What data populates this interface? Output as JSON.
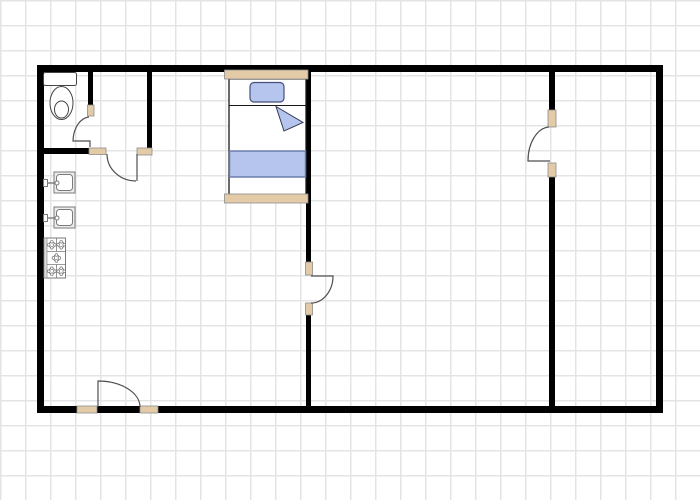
{
  "canvas": {
    "width": 700,
    "height": 500,
    "bg": "#ffffff",
    "grid": {
      "size_px": 25,
      "line_px": 1.5,
      "line_color": "#e4e4e4"
    }
  },
  "palette": {
    "wall": "#000000",
    "threshold_fill": "#e2cba6",
    "threshold_stroke": "#8c8c8c",
    "door_stroke": "#4f4f4f",
    "fixture_stroke": "#7a7a7a",
    "toilet_stroke": "#444444",
    "textile_fill": "#b5c5ee",
    "textile_stroke": "#44507a"
  },
  "shapes": [
    {
      "name": "wall-top",
      "type": "rect",
      "x": 37,
      "y": 65,
      "w": 626,
      "h": 7,
      "fill": "#000000"
    },
    {
      "name": "wall-bottom",
      "type": "rect",
      "x": 37,
      "y": 406,
      "w": 626,
      "h": 7,
      "fill": "#000000"
    },
    {
      "name": "wall-left",
      "type": "rect",
      "x": 37,
      "y": 65,
      "w": 7,
      "h": 348,
      "fill": "#000000"
    },
    {
      "name": "wall-right",
      "type": "rect",
      "x": 656,
      "y": 65,
      "w": 7,
      "h": 348,
      "fill": "#000000"
    },
    {
      "name": "wall-bathroom-east",
      "type": "rect",
      "x": 88,
      "y": 72,
      "w": 5,
      "h": 34,
      "fill": "#000000"
    },
    {
      "name": "wall-bathroom-south",
      "type": "rect",
      "x": 44,
      "y": 148,
      "w": 45,
      "h": 6,
      "fill": "#000000"
    },
    {
      "name": "wall-closet-east",
      "type": "rect",
      "x": 147,
      "y": 72,
      "w": 5,
      "h": 77,
      "fill": "#000000"
    },
    {
      "name": "wall-middle-upper",
      "type": "rect",
      "x": 306,
      "y": 72,
      "w": 5,
      "h": 190,
      "fill": "#000000"
    },
    {
      "name": "wall-middle-lower",
      "type": "rect",
      "x": 306,
      "y": 315,
      "w": 5,
      "h": 91,
      "fill": "#000000"
    },
    {
      "name": "wall-right-interior-upper",
      "type": "rect",
      "x": 549,
      "y": 72,
      "w": 6,
      "h": 38,
      "fill": "#000000"
    },
    {
      "name": "wall-right-interior-lower",
      "type": "rect",
      "x": 549,
      "y": 177,
      "w": 6,
      "h": 229,
      "fill": "#000000"
    },
    {
      "name": "door-jamb-bathroom",
      "type": "rect",
      "x": 87.5,
      "y": 105,
      "w": 6.5,
      "h": 11,
      "fill": "#e2cba6",
      "stroke": "#8c8c8c",
      "sw": 0.8
    },
    {
      "name": "door-jamb-closet-left",
      "type": "rect",
      "x": 89,
      "y": 148,
      "w": 17,
      "h": 6.5,
      "fill": "#e2cba6",
      "stroke": "#8c8c8c",
      "sw": 0.8
    },
    {
      "name": "door-jamb-closet-right",
      "type": "rect",
      "x": 137,
      "y": 148,
      "w": 15,
      "h": 7,
      "fill": "#e2cba6",
      "stroke": "#8c8c8c",
      "sw": 0.8
    },
    {
      "name": "door-jamb-middle-top",
      "type": "rect",
      "x": 305.5,
      "y": 262,
      "w": 7,
      "h": 13,
      "fill": "#e2cba6",
      "stroke": "#8c8c8c",
      "sw": 0.8
    },
    {
      "name": "door-jamb-middle-bottom",
      "type": "rect",
      "x": 305.5,
      "y": 303,
      "w": 7,
      "h": 12,
      "fill": "#e2cba6",
      "stroke": "#8c8c8c",
      "sw": 0.8
    },
    {
      "name": "door-jamb-right-top",
      "type": "rect",
      "x": 548,
      "y": 110,
      "w": 8,
      "h": 17,
      "fill": "#e2cba6",
      "stroke": "#8c8c8c",
      "sw": 0.8
    },
    {
      "name": "door-jamb-right-bottom",
      "type": "rect",
      "x": 548,
      "y": 163,
      "w": 8,
      "h": 14,
      "fill": "#e2cba6",
      "stroke": "#8c8c8c",
      "sw": 0.8
    },
    {
      "name": "door-jamb-entry-left",
      "type": "rect",
      "x": 77,
      "y": 406,
      "w": 20,
      "h": 7,
      "fill": "#e2cba6",
      "stroke": "#8c8c8c",
      "sw": 0.8
    },
    {
      "name": "door-jamb-entry-right",
      "type": "rect",
      "x": 140,
      "y": 406,
      "w": 18,
      "h": 7,
      "fill": "#e2cba6",
      "stroke": "#8c8c8c",
      "sw": 0.8
    },
    {
      "name": "door-bathroom",
      "type": "path",
      "d": "M89 117 A17 25 0 0 0 73 141 L90 141 L90 147",
      "stroke": "#4f4f4f",
      "sw": 1.2
    },
    {
      "name": "door-closet",
      "type": "path",
      "d": "M137 154 L137 181 M136 181 A29 27 0 0 1 107 154",
      "stroke": "#4f4f4f",
      "sw": 1.2
    },
    {
      "name": "door-middle-room",
      "type": "path",
      "d": "M311 276 L333 276 A22 27 0 0 1 311 303",
      "stroke": "#4f4f4f",
      "sw": 1.2
    },
    {
      "name": "door-right-room",
      "type": "path",
      "d": "M550 161 L528 161 A22 34 0 0 1 549 127",
      "stroke": "#4f4f4f",
      "sw": 1.2
    },
    {
      "name": "door-entry",
      "type": "path",
      "d": "M98 407 L98 381 A42 26 0 0 1 140 407",
      "stroke": "#4f4f4f",
      "sw": 1.2
    },
    {
      "name": "toilet-tank",
      "type": "rect",
      "x": 43.5,
      "y": 72.5,
      "w": 33,
      "h": 13,
      "rx": 2,
      "fill": "#ffffff",
      "stroke": "#444444",
      "sw": 1
    },
    {
      "name": "toilet-bowl",
      "type": "ellipse",
      "cx": 61.5,
      "cy": 103,
      "rx": 11.5,
      "ry": 16.5,
      "fill": "#ffffff",
      "stroke": "#444444",
      "sw": 1
    },
    {
      "name": "toilet-bowl-inner",
      "type": "ellipse",
      "cx": 61.5,
      "cy": 109.5,
      "rx": 7,
      "ry": 8.5,
      "fill": "none",
      "stroke": "#444444",
      "sw": 1
    },
    {
      "name": "sink-1-basin",
      "type": "rect",
      "x": 54,
      "y": 172,
      "w": 21,
      "h": 21,
      "fill": "#ededed",
      "stroke": "#7a7a7a",
      "sw": 1
    },
    {
      "name": "sink-1-basin-inner",
      "type": "rect",
      "x": 56.5,
      "y": 174.5,
      "w": 16,
      "h": 16,
      "rx": 3,
      "fill": "#ffffff",
      "stroke": "#7a7a7a",
      "sw": 1
    },
    {
      "name": "sink-1-tap-base",
      "type": "rect",
      "x": 43.5,
      "y": 179.5,
      "w": 4,
      "h": 7,
      "fill": "#ffffff",
      "stroke": "#7a7a7a",
      "sw": 1
    },
    {
      "name": "sink-1-tap-pipe",
      "type": "path",
      "d": "M47.5 183 L58 183",
      "stroke": "#7a7a7a",
      "sw": 1.4
    },
    {
      "name": "sink-1-tap-knob",
      "type": "circle",
      "cx": 57,
      "cy": 183,
      "r": 2,
      "fill": "#ffffff",
      "stroke": "#7a7a7a",
      "sw": 1
    },
    {
      "name": "sink-2-basin",
      "type": "rect",
      "x": 54,
      "y": 207,
      "w": 21,
      "h": 21,
      "fill": "#ededed",
      "stroke": "#7a7a7a",
      "sw": 1
    },
    {
      "name": "sink-2-basin-inner",
      "type": "rect",
      "x": 56.5,
      "y": 209.5,
      "w": 16,
      "h": 16,
      "rx": 3,
      "fill": "#ffffff",
      "stroke": "#7a7a7a",
      "sw": 1
    },
    {
      "name": "sink-2-tap-base",
      "type": "rect",
      "x": 43.5,
      "y": 214.5,
      "w": 4,
      "h": 7,
      "fill": "#ffffff",
      "stroke": "#7a7a7a",
      "sw": 1
    },
    {
      "name": "sink-2-tap-pipe",
      "type": "path",
      "d": "M47.5 218 L58 218",
      "stroke": "#7a7a7a",
      "sw": 1.4
    },
    {
      "name": "sink-2-tap-knob",
      "type": "circle",
      "cx": 57,
      "cy": 218,
      "r": 2,
      "fill": "#ffffff",
      "stroke": "#7a7a7a",
      "sw": 1
    },
    {
      "name": "stove-body",
      "type": "rect",
      "x": 44,
      "y": 238,
      "w": 21.5,
      "h": 40,
      "fill": "#ffffff",
      "stroke": "#7a7a7a",
      "sw": 1
    },
    {
      "name": "stove-left-rail",
      "type": "rect",
      "x": 44,
      "y": 238,
      "w": 3,
      "h": 40,
      "fill": "#dcdcdc",
      "stroke": "#7a7a7a",
      "sw": 0.6
    },
    {
      "name": "stove-divider-top",
      "type": "path",
      "d": "M47 251.5 L65.5 251.5",
      "stroke": "#7a7a7a",
      "sw": 0.8
    },
    {
      "name": "stove-divider-bottom",
      "type": "path",
      "d": "M47 264.5 L65.5 264.5",
      "stroke": "#7a7a7a",
      "sw": 0.8
    },
    {
      "name": "stove-divider-upper-mid",
      "type": "path",
      "d": "M56.5 238 L56.5 251.5",
      "stroke": "#7a7a7a",
      "sw": 0.8
    },
    {
      "name": "stove-divider-lower-mid",
      "type": "path",
      "d": "M56.5 264.5 L56.5 278",
      "stroke": "#7a7a7a",
      "sw": 0.8
    },
    {
      "name": "stove-burner-1",
      "type": "burner",
      "cx": 51.8,
      "cy": 244.8,
      "r": 3,
      "fill": "#ffffff",
      "stroke": "#7a7a7a",
      "sw": 0.9
    },
    {
      "name": "stove-burner-2",
      "type": "burner",
      "cx": 61.2,
      "cy": 244.8,
      "r": 3,
      "fill": "#ffffff",
      "stroke": "#7a7a7a",
      "sw": 0.9
    },
    {
      "name": "stove-burner-3",
      "type": "burner",
      "cx": 56.4,
      "cy": 258,
      "r": 3,
      "fill": "#ffffff",
      "stroke": "#7a7a7a",
      "sw": 0.9
    },
    {
      "name": "stove-burner-4",
      "type": "burner",
      "cx": 51.8,
      "cy": 271.2,
      "r": 3,
      "fill": "#ffffff",
      "stroke": "#7a7a7a",
      "sw": 0.9
    },
    {
      "name": "stove-burner-5",
      "type": "burner",
      "cx": 61.2,
      "cy": 271.2,
      "r": 3,
      "fill": "#ffffff",
      "stroke": "#7a7a7a",
      "sw": 0.9
    },
    {
      "name": "bed-frame",
      "type": "rect",
      "x": 229,
      "y": 79,
      "w": 77,
      "h": 118,
      "fill": "#ffffff",
      "stroke": "#1a1a1a",
      "sw": 1.3
    },
    {
      "name": "bed-headboard",
      "type": "rect",
      "x": 224.5,
      "y": 70,
      "w": 83.5,
      "h": 9,
      "fill": "#e2cba6",
      "stroke": "#8c8c8c",
      "sw": 0.8
    },
    {
      "name": "bed-footboard",
      "type": "rect",
      "x": 224.5,
      "y": 194,
      "w": 83.5,
      "h": 9,
      "fill": "#e2cba6",
      "stroke": "#8c8c8c",
      "sw": 0.8
    },
    {
      "name": "bed-sheet-line",
      "type": "path",
      "d": "M229 105.5 L306 105.5",
      "stroke": "#1a1a1a",
      "sw": 1
    },
    {
      "name": "bed-pillow",
      "type": "rect",
      "x": 250,
      "y": 82.5,
      "w": 34,
      "h": 19.5,
      "rx": 4,
      "fill": "#b5c5ee",
      "stroke": "#44507a",
      "sw": 1.2
    },
    {
      "name": "bed-blanket-fold",
      "type": "polygon",
      "points": "276,106.5 303,122.5 284,131",
      "fill": "#b5c5ee",
      "stroke": "#333a55",
      "sw": 1
    },
    {
      "name": "bed-blanket",
      "type": "rect",
      "x": 229.5,
      "y": 151,
      "w": 76,
      "h": 26,
      "fill": "#b5c5ee",
      "stroke": "#6477a8",
      "sw": 1.4
    }
  ]
}
